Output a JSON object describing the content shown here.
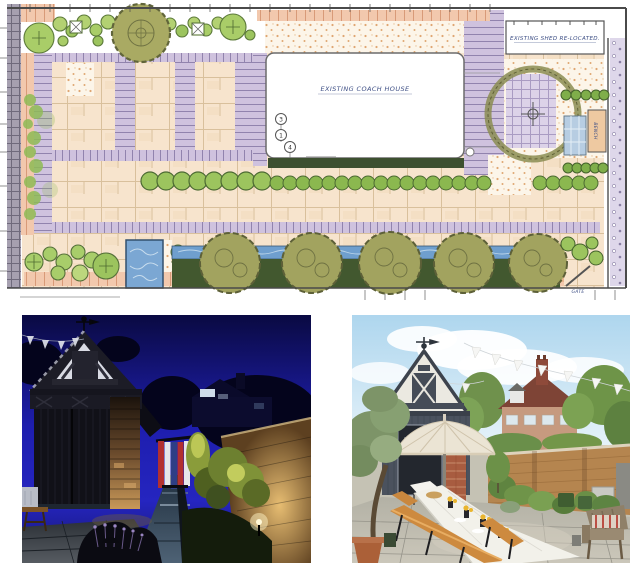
{
  "page": {
    "title": "Garden design — masterplan with before/after courtyard photos",
    "background": "#ffffff"
  },
  "plan": {
    "name": "hand-drawn-garden-masterplan",
    "labels": {
      "shed": "EXISTING SHED RE-LOCATED.",
      "coach_house": "EXISTING COACH HOUSE",
      "bench": "BENCH",
      "gate": "GATE"
    },
    "callouts": [
      "3",
      "1",
      "4"
    ],
    "palette": {
      "paper": "#ffffff",
      "paving": "#f7e4cd",
      "paving_joint": "#d9c09c",
      "brick_band": "#cfc2de",
      "brick_joint": "#9183ad",
      "gravel": "#fcf5e9",
      "gravel_dot": "#dfa671",
      "planting_green": "#b3d172",
      "planting_outline": "#5c7a3a",
      "tree_olive": "#a9aa63",
      "tree_outline": "#61653a",
      "hedge_dark": "#42582f",
      "water_blue": "#7ba7d3",
      "rill_blue": "#6f9fce",
      "edging_pink": "#f2c8ad",
      "ink_blue": "#3f5086"
    }
  },
  "photos": {
    "night": {
      "name": "courtyard-at-night",
      "alt": "Coach house and lit garden path at night",
      "sky": "#1e1eae"
    },
    "day": {
      "name": "courtyard-by-day",
      "alt": "Garden dining under a parasol beside the coach house",
      "sky": "#aed6ee"
    }
  }
}
